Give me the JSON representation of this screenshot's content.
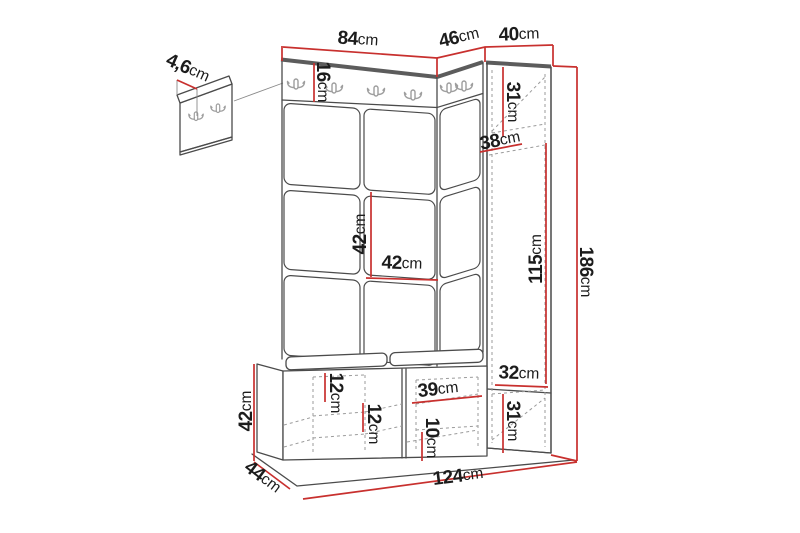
{
  "colors": {
    "background": "#ffffff",
    "outline": "#4b4b4b",
    "outline_thick": "#5c5c5c",
    "dashed": "#9b9b9b",
    "dimension": "#c8302e",
    "text": "#1c1c1c",
    "hook": "#9e9e9e"
  },
  "dimensions": {
    "wall_panel_depth": {
      "value": "4,6",
      "unit": "cm"
    },
    "top_width_left_section": {
      "value": "84",
      "unit": "cm"
    },
    "top_width_corner_section": {
      "value": "46",
      "unit": "cm"
    },
    "top_width_right_column": {
      "value": "40",
      "unit": "cm"
    },
    "hook_rail_height": {
      "value": "16",
      "unit": "cm"
    },
    "column_upper_section_height": {
      "value": "31",
      "unit": "cm"
    },
    "column_shelf_width": {
      "value": "38",
      "unit": "cm"
    },
    "panel_tile_height": {
      "value": "42",
      "unit": "cm"
    },
    "panel_tile_width": {
      "value": "42",
      "unit": "cm"
    },
    "column_door_height": {
      "value": "115",
      "unit": "cm"
    },
    "total_height": {
      "value": "186",
      "unit": "cm"
    },
    "column_bottom_width": {
      "value": "32",
      "unit": "cm"
    },
    "column_bottom_height": {
      "value": "31",
      "unit": "cm"
    },
    "bench_left_shelf_gap": {
      "value": "12",
      "unit": "cm"
    },
    "bench_middle_shelf_gap": {
      "value": "12",
      "unit": "cm"
    },
    "bench_compartment_width": {
      "value": "39",
      "unit": "cm"
    },
    "bench_right_shelf_gap": {
      "value": "10",
      "unit": "cm"
    },
    "bench_height": {
      "value": "42",
      "unit": "cm"
    },
    "bench_depth": {
      "value": "44",
      "unit": "cm"
    },
    "total_width": {
      "value": "124",
      "unit": "cm"
    }
  }
}
